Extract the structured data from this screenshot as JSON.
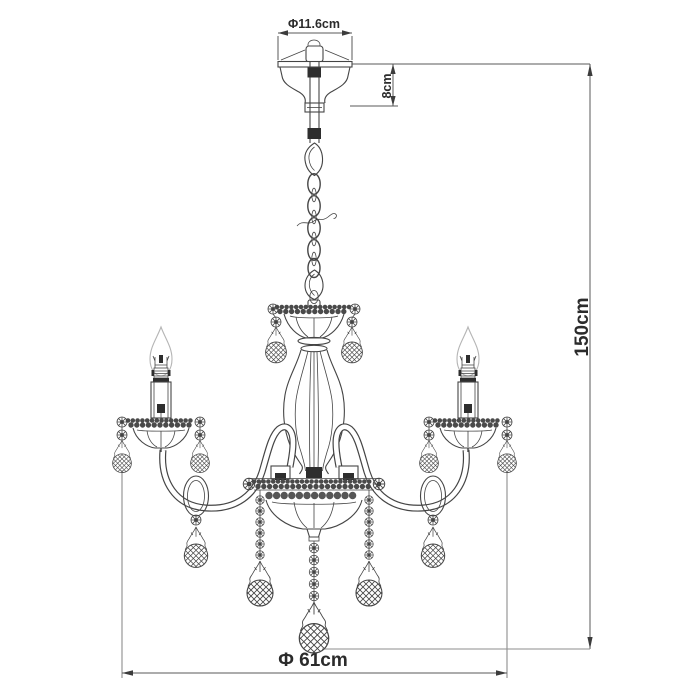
{
  "diagram": {
    "subject": "chandelier dimension line drawing",
    "labels": {
      "canopy_diameter": "Φ11.6cm",
      "canopy_height": "8cm",
      "overall_height": "150cm",
      "fixture_diameter": "Φ 61cm"
    },
    "colors": {
      "line": "#454545",
      "dimension": "#5a5a5a",
      "extension": "#8e8e8e",
      "flame_outline": "#b5b5b5",
      "dark_fill": "#2e2e2e",
      "background": "#ffffff"
    }
  }
}
